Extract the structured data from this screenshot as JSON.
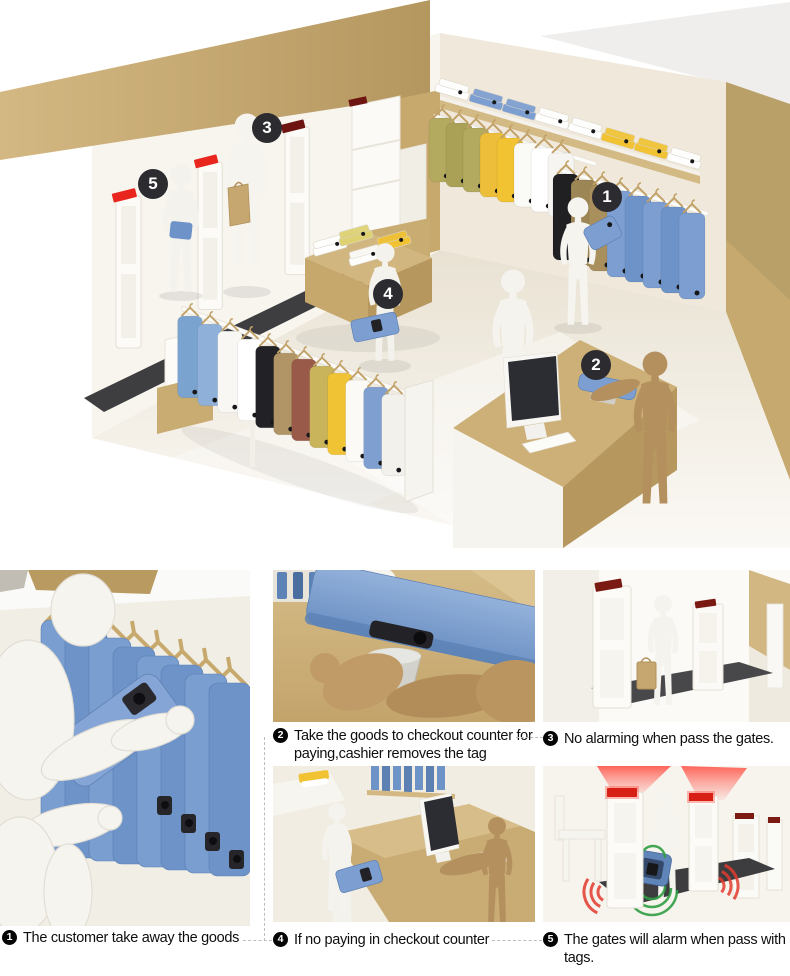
{
  "steps": [
    {
      "num": "1",
      "text": "The customer take away the goods"
    },
    {
      "num": "2",
      "text": "Take the goods to checkout counter for paying,cashier removes the tag"
    },
    {
      "num": "3",
      "text": "No alarming when pass the gates."
    },
    {
      "num": "4",
      "text": "If no paying in checkout counter"
    },
    {
      "num": "5",
      "text": "The gates will alarm when pass with tags."
    }
  ],
  "colors": {
    "tan": "#c9ab74",
    "ivory_wall": "#f0e9db",
    "blue_garment": "#7c9ed1",
    "yellow_garment": "#f1c232",
    "olive_garment": "#b3aa60",
    "floor_mat": "#3e3e41",
    "gate_cap_red": "#e8261d",
    "gate_cap_maroon": "#6e1511",
    "alarm_red": "#d81f16",
    "signal_green": "#2f9e43",
    "mannequin_brown": "#b4905f",
    "badge_dark": "#2b2b30"
  }
}
